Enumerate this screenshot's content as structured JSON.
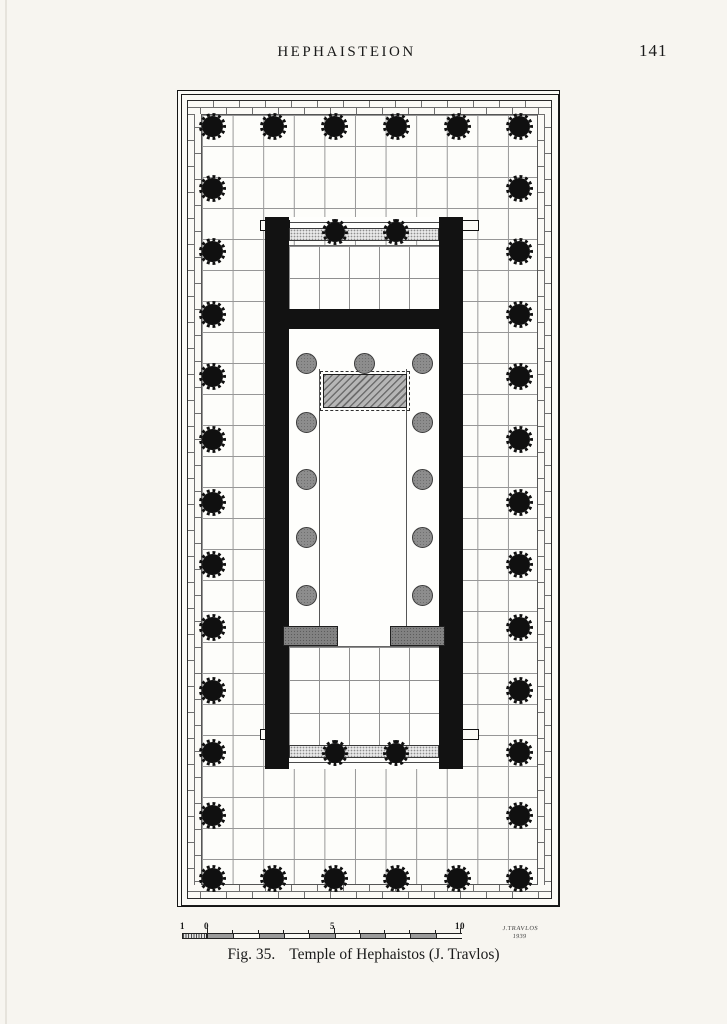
{
  "header": {
    "title": "HEPHAISTEION",
    "page_number": "141"
  },
  "figure": {
    "caption_label": "Fig. 35.",
    "caption_text": "Temple of Hephaistos (J. Travlos)",
    "signature_name": "J.TRAVLOS",
    "signature_year": "1939",
    "scale_labels": [
      "1",
      "0",
      "5",
      "10"
    ],
    "scale_segments": 10
  },
  "plan": {
    "subject": "Temple of Hephaistos floor plan",
    "peristyle": {
      "front_columns": 6,
      "flank_columns": 13
    },
    "porch_columns_each_end": 2,
    "interior_columns": {
      "rear_row": 3,
      "side_pairs": 4
    },
    "features": [
      "statue-base",
      "cella",
      "pronaos",
      "opisthodomos",
      "stylobate-steps"
    ],
    "colors": {
      "ink": "#141414",
      "paper": "#f7f5f0",
      "grid_line": "#979797",
      "gray_column": "#8d8d8d",
      "band_fill": "#e7e7e7",
      "base_fill": "#b6b6b6",
      "door_block": "#828282"
    }
  }
}
